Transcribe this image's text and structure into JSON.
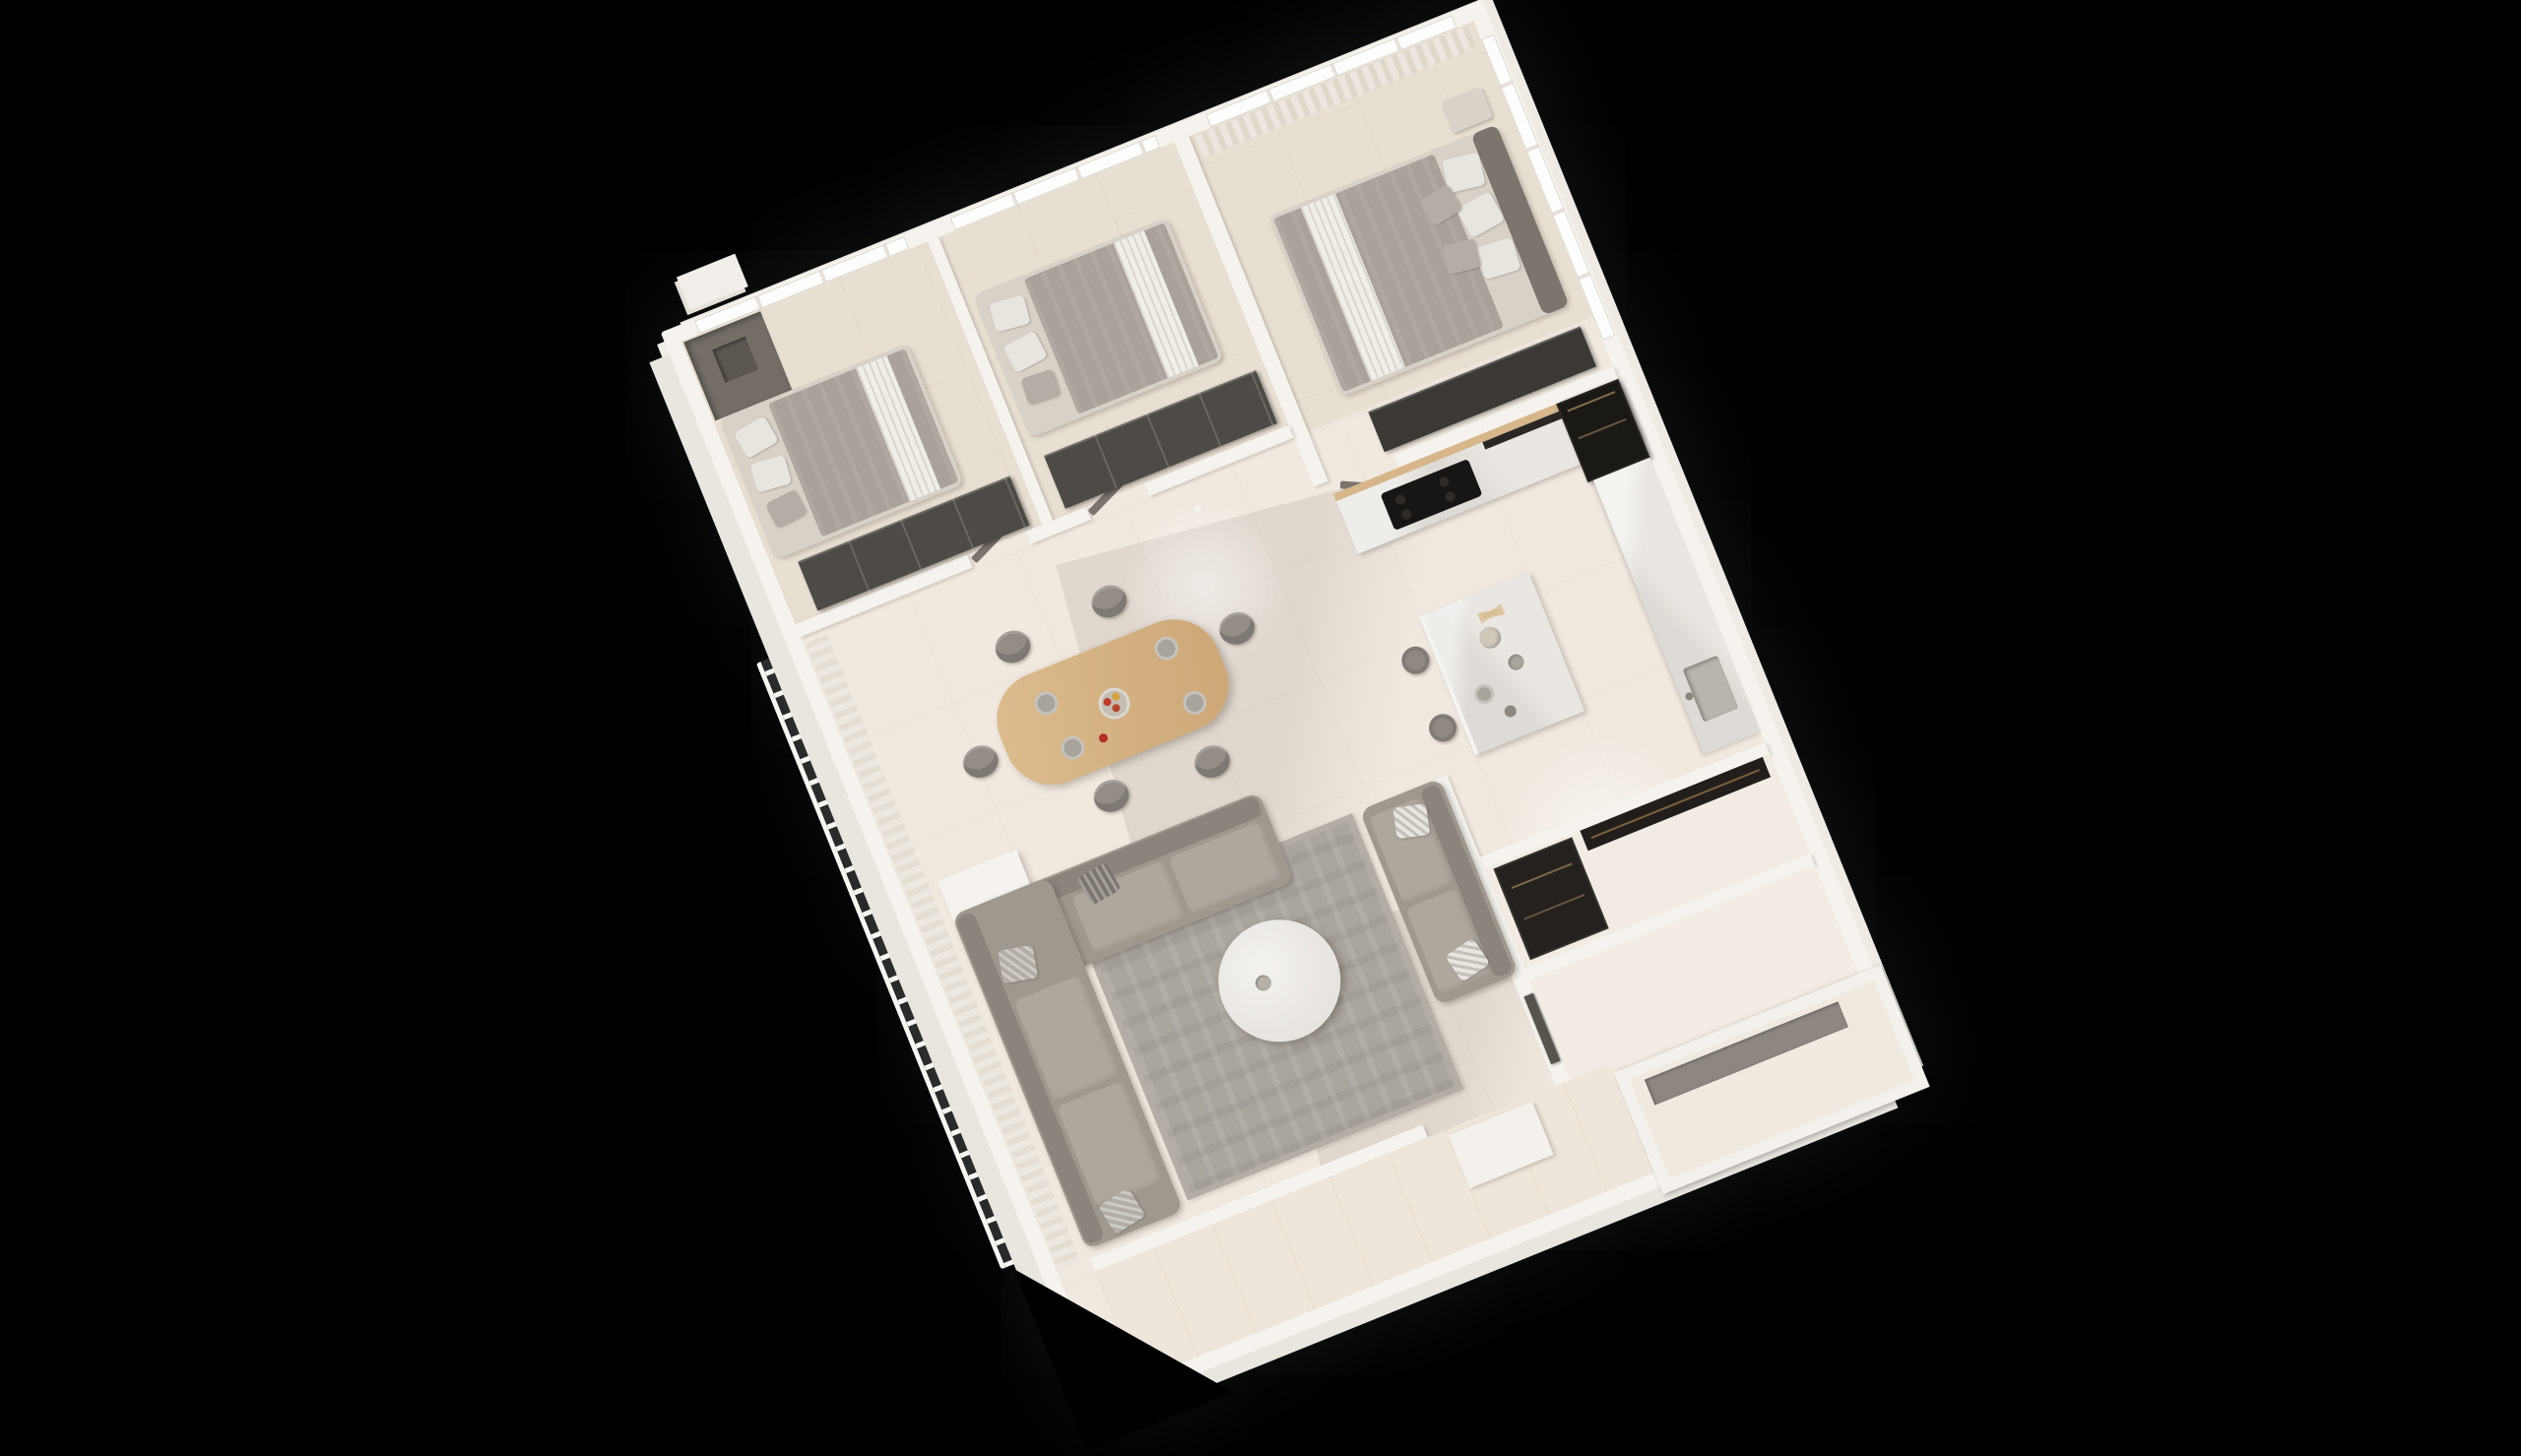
{
  "scene": {
    "type": "isometric-3d-floorplan-render",
    "description": "Photorealistic top-down 3D render of a furnished apartment, rotated about 22 degrees counter-clockwise on a black background",
    "rotation_deg": -22,
    "background": "#000000"
  },
  "palette": {
    "bg": "#000000",
    "wall": "#f6f3ee",
    "wallShade": "#e9e5df",
    "floorMain": "#f0e9e0",
    "floorBedroom": "#e8dfd3",
    "floorWarm": "#eee6da",
    "wood": "#d7b78a",
    "tableWood": "#d8b686",
    "darkUnit": "#1b1916",
    "wardrobeDark": "#4e4a45",
    "wardrobeDarker": "#3c3834",
    "sofa": "#9e988f",
    "sofaBack": "#8a847c",
    "cushion": "#ada79e",
    "duvet": "#a9a29a",
    "runner": "#f1eee8",
    "marble": "#eae7e2",
    "island": "#edebe7",
    "rug": "#aaa59d",
    "chair": "#938d86",
    "stool": "#8f8982",
    "curtain": "#e7e2db",
    "glass": "#fdfdfc",
    "doorDark": "#57534d",
    "cooktop": "#181614",
    "fruitRed": "#c0392b",
    "fruitYellow": "#d4a23c"
  },
  "rooms": [
    {
      "id": "bedroom-1",
      "label": "Bedroom 1",
      "furniture": [
        "double-bed",
        "pillows",
        "wardrobe-dark",
        "closet-niche",
        "window"
      ]
    },
    {
      "id": "bedroom-2",
      "label": "Bedroom 2",
      "furniture": [
        "double-bed",
        "pillows",
        "wardrobe-dark",
        "window"
      ]
    },
    {
      "id": "master-bedroom",
      "label": "Master Bedroom",
      "furniture": [
        "double-bed",
        "headboard",
        "nightstand",
        "wardrobe-dark",
        "sheer-curtains",
        "window"
      ]
    },
    {
      "id": "dining-area",
      "label": "Dining Area",
      "furniture": [
        "wood-dining-table",
        "six-chairs",
        "fruit-bowl",
        "plates"
      ]
    },
    {
      "id": "kitchen",
      "label": "Kitchen",
      "furniture": [
        "cooktop-counter",
        "tall-black-unit",
        "right-counter-with-sink",
        "island",
        "two-bar-stools",
        "pampas-vase"
      ]
    },
    {
      "id": "living-room",
      "label": "Living Room",
      "furniture": [
        "sectional-sofa",
        "loveseat",
        "round-marble-coffee-table",
        "area-rug",
        "throw-pillows"
      ]
    },
    {
      "id": "balcony",
      "label": "Balcony",
      "furniture": [
        "railing",
        "sheer-curtains",
        "column"
      ]
    },
    {
      "id": "bathroom-hall",
      "label": "Bath / Hall",
      "furniture": [
        "dark-closet",
        "dark-door",
        "empty-rooms"
      ]
    },
    {
      "id": "entry",
      "label": "Entry",
      "furniture": [
        "sheer-curtain",
        "cabinet"
      ]
    },
    {
      "id": "terrace",
      "label": "Terrace",
      "furniture": [
        "planter-box"
      ]
    }
  ]
}
